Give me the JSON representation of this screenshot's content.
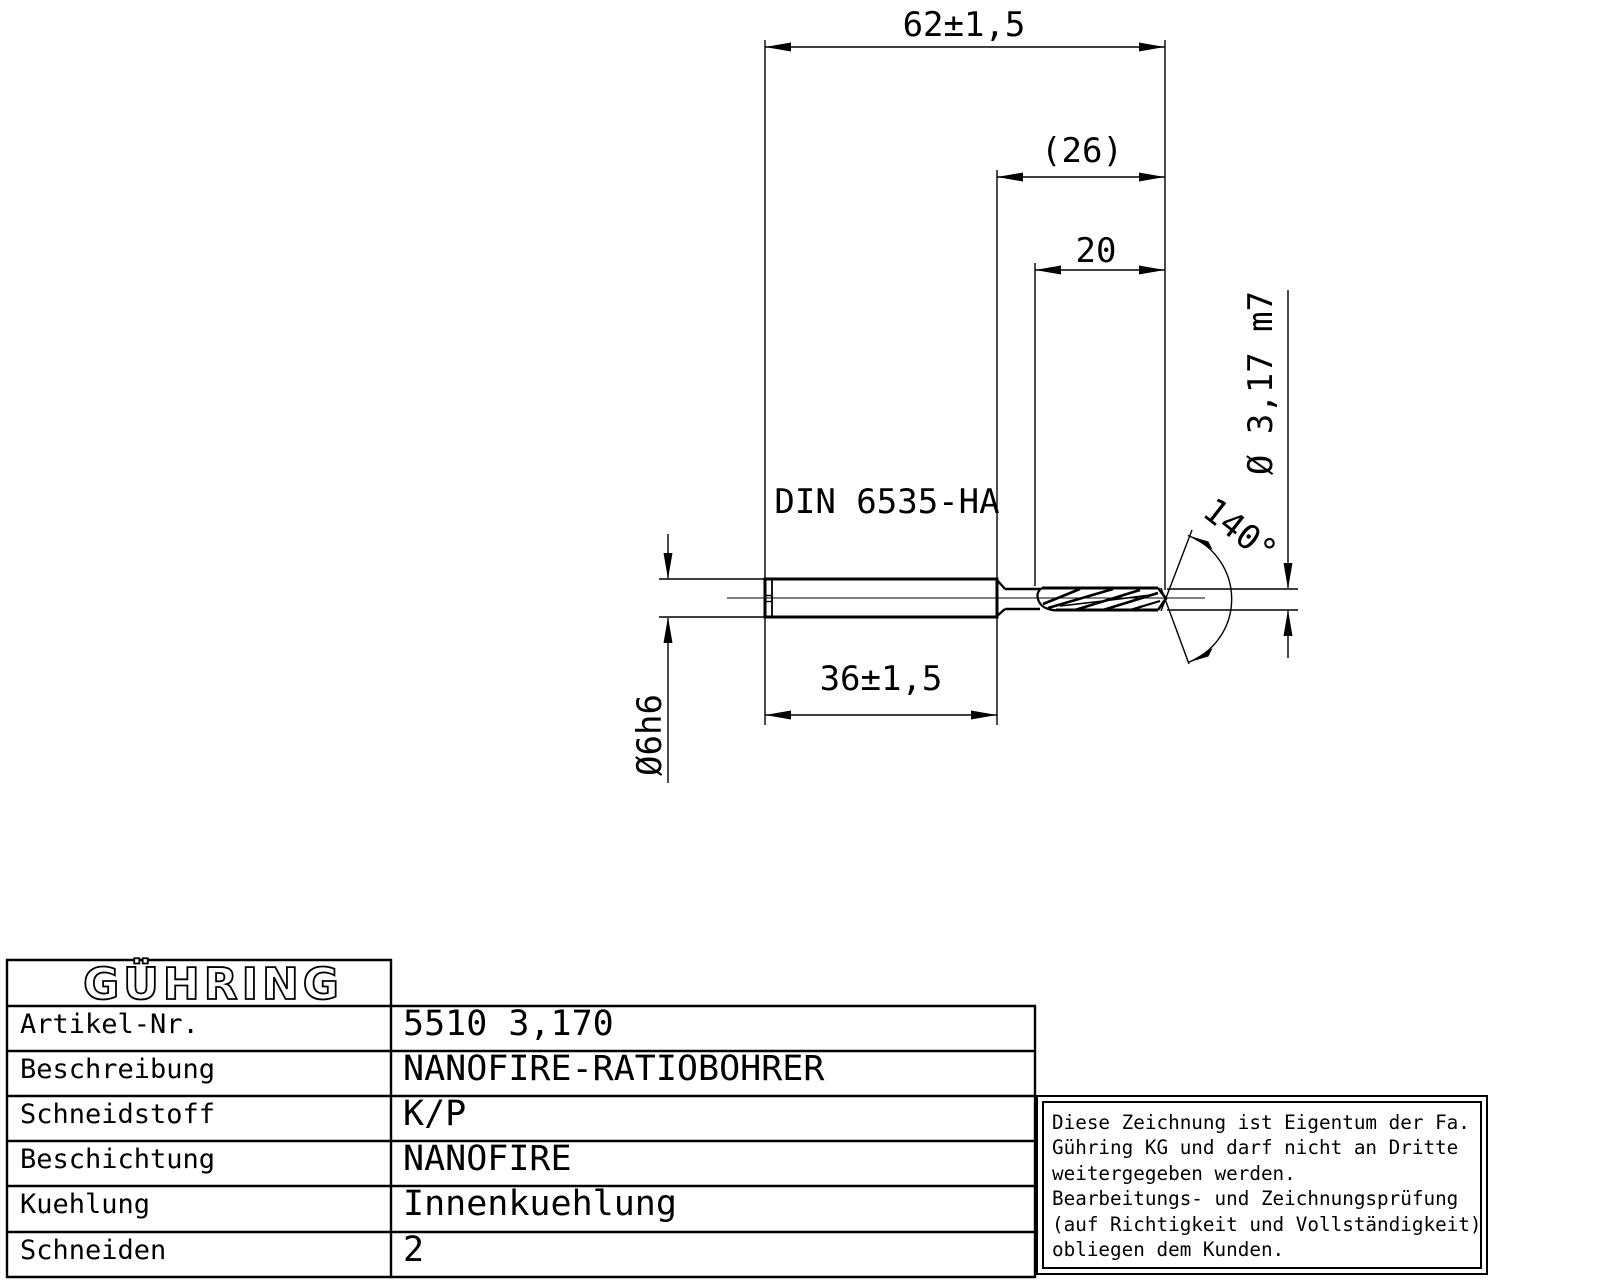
{
  "drawing": {
    "dim_overall_length": "62±1,5",
    "dim_ref_length": "(26)",
    "dim_flute_length": "20",
    "dim_cut_diameter": "Ø 3,17 m7",
    "dim_point_angle": "140°",
    "shank_standard": "DIN 6535-HA",
    "dim_shank_length": "36±1,5",
    "dim_shank_diameter": "Ø6h6",
    "line_color": "#000000"
  },
  "table": {
    "logo": "GÜHRING",
    "rows": [
      {
        "label": "Artikel-Nr.",
        "value": "5510 3,170"
      },
      {
        "label": "Beschreibung",
        "value": "NANOFIRE-RATIOBOHRER"
      },
      {
        "label": "Schneidstoff",
        "value": "K/P"
      },
      {
        "label": "Beschichtung",
        "value": "NANOFIRE"
      },
      {
        "label": "Kuehlung",
        "value": "Innenkuehlung"
      },
      {
        "label": "Schneiden",
        "value": "2"
      }
    ]
  },
  "notice": {
    "lines": [
      "Diese Zeichnung ist Eigentum der Fa.",
      "Gühring KG und darf nicht an Dritte",
      "weitergegeben werden.",
      "Bearbeitungs- und Zeichnungsprüfung",
      "(auf Richtigkeit und Vollständigkeit)",
      "obliegen dem Kunden."
    ]
  }
}
